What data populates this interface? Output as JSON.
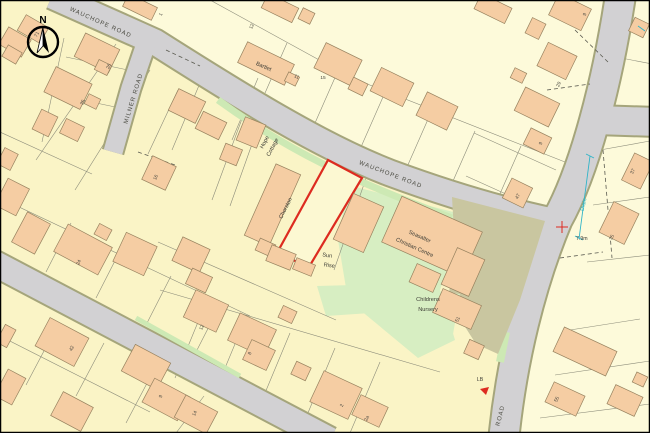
{
  "map": {
    "north_label": "N",
    "roads": {
      "wauchope_west": "WAUCHOPE ROAD",
      "wauchope_main": "WAUCHOPE ROAD",
      "milner": "MILNER ROAD",
      "road_partial": "ROAD"
    },
    "labels": {
      "bartlet": "Bartlet",
      "hope_line1": "Hope",
      "hope_line2": "Cottage",
      "chorston": "Chorston",
      "sun_line1": "Sun",
      "sun_line2": "Rise",
      "centre_line1": "Seasalter",
      "centre_line2": "Christian Centre",
      "nursery_line1": "Childrens",
      "nursery_line2": "Nursery",
      "drain": "Drain",
      "spot_height": "7.9m",
      "letter_box": "LB"
    },
    "house_numbers": [
      "71",
      "26",
      "35",
      "1",
      "12",
      "11",
      "15",
      "9",
      "29",
      "9",
      "47",
      "37",
      "35",
      "51",
      "16",
      "24",
      "12",
      "8",
      "2",
      "2a",
      "42",
      "9",
      "14",
      "55"
    ],
    "colors": {
      "background": "#FAF4C6",
      "background_light": "#FDFADA",
      "building": "#F5CDA3",
      "building_stroke": "#97825F",
      "road": "#D2D1D3",
      "road_casing": "#A5A57B",
      "green": "#D7EEC2",
      "verge": "#CDE9B4",
      "hardstanding": "#C9C6A0",
      "plot_outline_red": "#DD2B20",
      "drain_cyan": "#2FB4C8"
    }
  }
}
